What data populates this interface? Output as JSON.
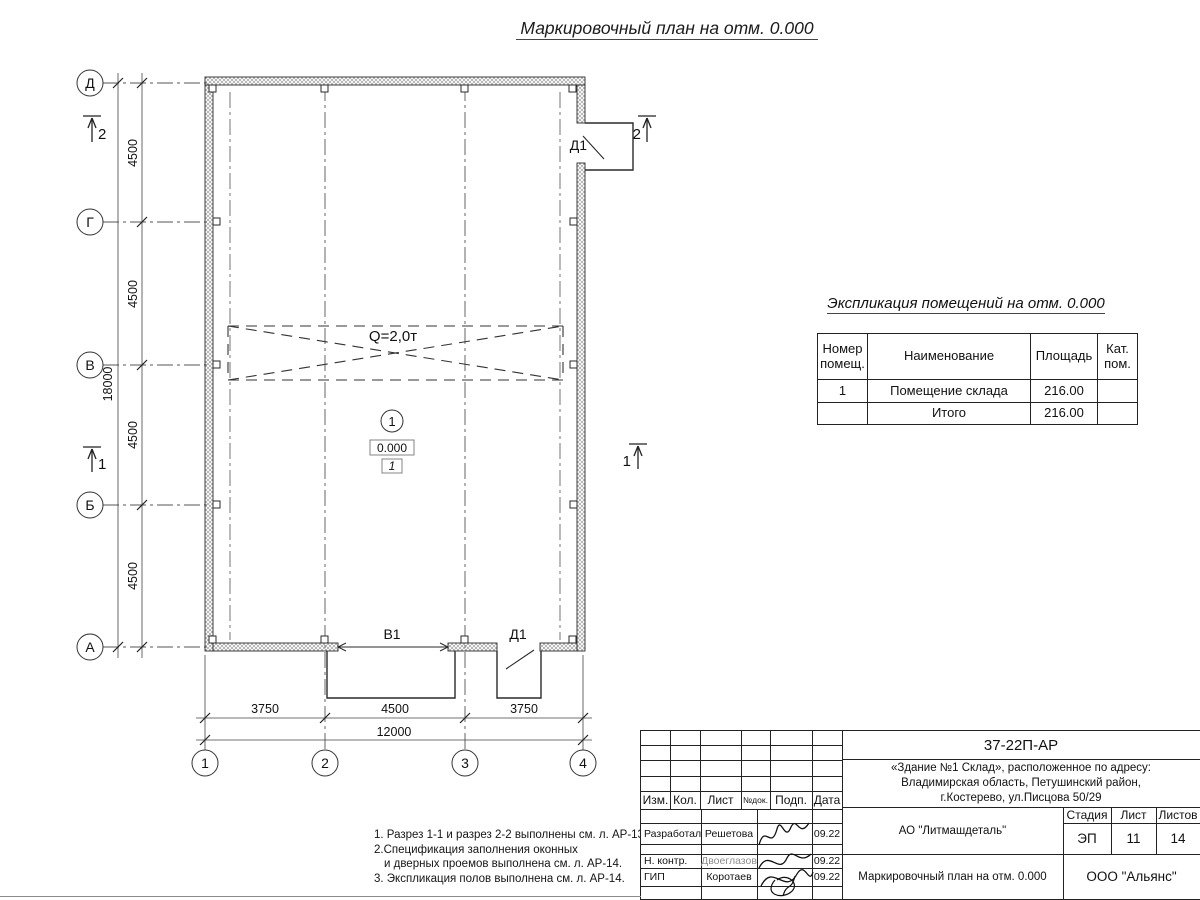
{
  "page": {
    "title": "Маркировочный план на отм. 0.000"
  },
  "plan": {
    "row_axes": [
      "Д",
      "Г",
      "В",
      "Б",
      "А"
    ],
    "col_axes": [
      "1",
      "2",
      "3",
      "4"
    ],
    "v_dims": [
      "4500",
      "4500",
      "4500",
      "4500"
    ],
    "v_total": "18000",
    "h_dims": [
      "3750",
      "4500",
      "3750"
    ],
    "h_total": "12000",
    "crane": "Q=2,0т",
    "room_number": "1",
    "level": "0.000",
    "floor_mark": "1",
    "door_top": "Д1",
    "door_bottom": "Д1",
    "gate": "В1",
    "section_marks": {
      "s1": "1",
      "s2": "2"
    }
  },
  "explication": {
    "title": "Экспликация помещений на отм. 0.000",
    "col_headers": [
      "Номер помещ.",
      "Наименование",
      "Площадь",
      "Кат. пом."
    ],
    "rows": [
      {
        "num": "1",
        "name": "Помещение склада",
        "area": "216.00",
        "cat": ""
      }
    ],
    "total_label": "Итого",
    "total_area": "216.00"
  },
  "notes": {
    "line1": "1. Разрез 1-1 и разрез 2-2 выполнены см. л. АР-13.",
    "line2": "2.Спецификация заполнения оконных",
    "line3": "и дверных проемов выполнена см. л. АР-14.",
    "line4": "3. Экспликация полов выполнена см. л. АР-14."
  },
  "title_block": {
    "doc_number": "37-22П-АР",
    "description_line1": "«Здание №1 Склад», расположенное по адресу:",
    "description_line2": "Владимирская область, Петушинский район,",
    "description_line3": "г.Костерево, ул.Писцова 50/29",
    "cols": [
      "Изм.",
      "Кол.",
      "Лист",
      "№док.",
      "Подп.",
      "Дата"
    ],
    "rows": [
      {
        "role": "Разработал",
        "name": "Решетова",
        "date": "09.22"
      },
      {
        "role": "Н. контр.",
        "name": "Двоеглазов",
        "date": "09.22"
      },
      {
        "role": "ГИП",
        "name": "Коротаев",
        "date": "09.22"
      }
    ],
    "company": "АО \"Литмашдеталь\"",
    "stage_label": "Стадия",
    "sheet_label": "Лист",
    "sheets_label": "Листов",
    "stage": "ЭП",
    "sheet": "11",
    "sheets": "14",
    "drawing_title": "Маркировочный план на отм. 0.000",
    "contractor": "ООО \"Альянс\""
  },
  "colors": {
    "line": "#222222",
    "muted": "#8d8d8d",
    "background": "#ffffff"
  }
}
